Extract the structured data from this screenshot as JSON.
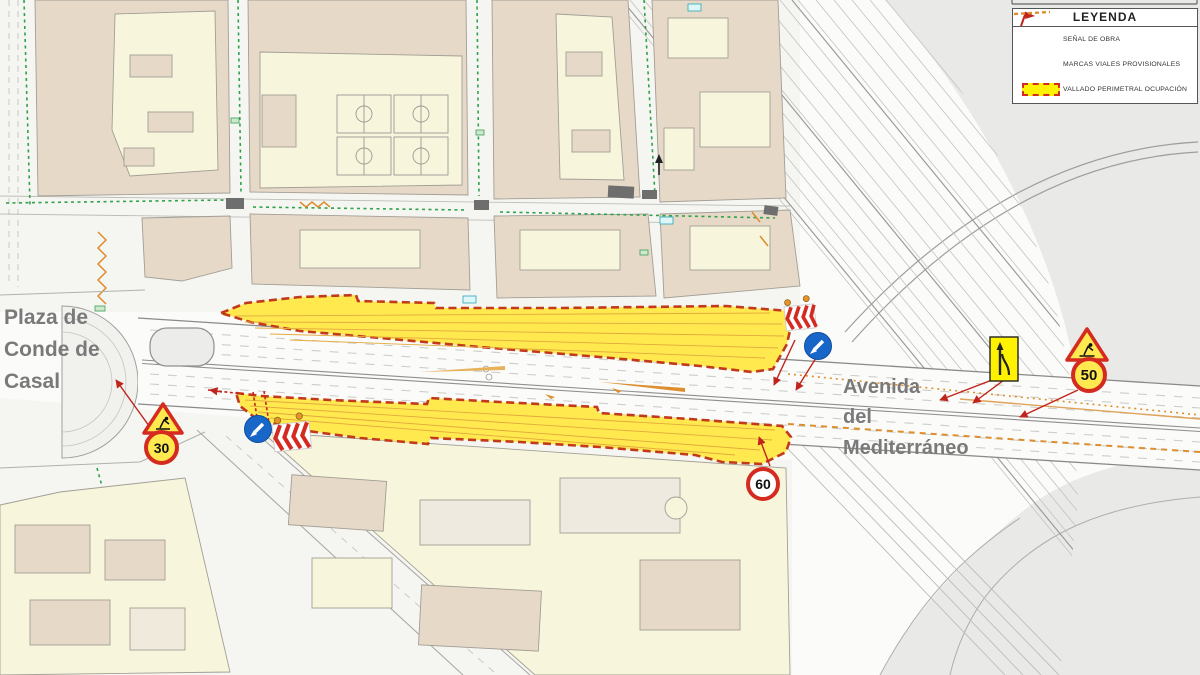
{
  "map": {
    "labels": {
      "plaza": {
        "line1": "Plaza de",
        "line2": "Conde de",
        "line3": "Casal"
      },
      "avenue": {
        "line1": "Avenida",
        "line2": "del",
        "line3": "Mediterráneo"
      }
    },
    "signs": {
      "speed_30": "30",
      "speed_50": "50",
      "speed_60": "60",
      "roadworks_triangle": "roadworks-warning",
      "mandatory_direction": "blue-arrow-keep-left",
      "lane_merge": "lane-ends-merge-left"
    },
    "colors": {
      "occupation_zone_fill": "#FFE94F",
      "occupation_zone_border": "#C23A1C",
      "provisional_marks_orange": "#DD8E2E",
      "building_fill": "#E6D9C8",
      "courtyard_fill": "#F7F6DC",
      "gray_area": "#E9E9E7",
      "green_landscape_dash": "#2FA24B",
      "sign_red": "#D42A20",
      "sign_blue": "#1766C8",
      "label_gray": "#7A7A7A"
    }
  },
  "legend": {
    "title": "LEYENDA",
    "items": [
      {
        "icon": "work-signal-flag-icon",
        "label": "SEÑAL DE OBRA"
      },
      {
        "icon": "orange-dashed-line-icon",
        "label": "MARCAS VIALES PROVISIONALES"
      },
      {
        "icon": "yellow-zone-swatch-icon",
        "label": "VALLADO PERIMETRAL OCUPACIÓN"
      }
    ]
  }
}
